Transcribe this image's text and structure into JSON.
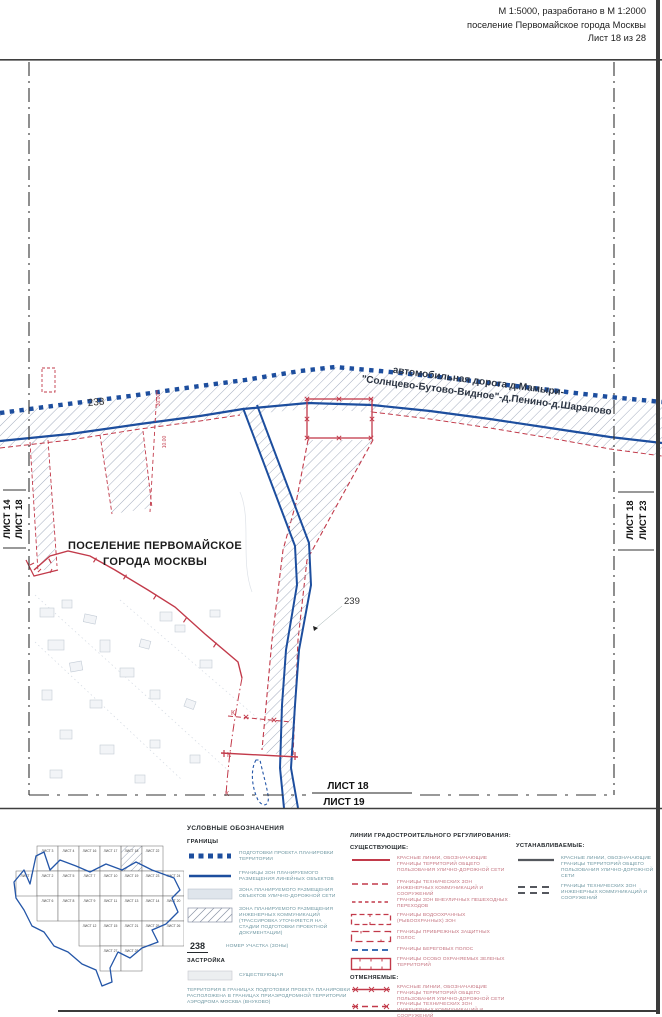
{
  "header": {
    "line1": "М 1:5000, разработано в М 1:2000",
    "line2": "поселение Первомайское города Москвы",
    "line3": "Лист 18 из 28"
  },
  "map": {
    "road_label_1": "автомобильная дорога д.Мамыри-",
    "road_label_2": "\"Солнцево-Бутово-Видное\"-д.Пенино-д.Шарапово",
    "settlement_1": "ПОСЕЛЕНИЕ ПЕРВОМАЙСКОЕ",
    "settlement_2": "ГОРОДА МОСКВЫ",
    "parcel_238": "238",
    "parcel_239": "239",
    "dim_a": "30.00",
    "dim_b": "10.00",
    "k": "К",
    "edge": {
      "left_outer": "ЛИСТ 14",
      "left_inner": "ЛИСТ 18",
      "right_inner": "ЛИСТ 18",
      "right_outer": "ЛИСТ 23",
      "bottom_top": "ЛИСТ 18",
      "bottom_bottom": "ЛИСТ 19"
    }
  },
  "legend": {
    "title": "УСЛОВНЫЕ ОБОЗНАЧЕНИЯ",
    "borders_section": "ГРАНИЦЫ",
    "borders_items": [
      {
        "label": "ПОДГОТОВКИ ПРОЕКТА ПЛАНИРОВКИ ТЕРРИТОРИИ"
      },
      {
        "label": "ГРАНИЦЫ ЗОН ПЛАНИРУЕМОГО РАЗМЕЩЕНИЯ ЛИНЕЙНЫХ ОБЪЕКТОВ"
      },
      {
        "label": "ЗОНА ПЛАНИРУЕМОГО РАЗМЕЩЕНИЯ ОБЪЕКТОВ УЛИЧНО-ДОРОЖНОЙ СЕТИ"
      },
      {
        "label": "ЗОНА ПЛАНИРУЕМОГО РАЗМЕЩЕНИЯ ИНЖЕНЕРНЫХ КОММУНИКАЦИЙ (ТРАССИРОВКА УТОЧНЯЕТСЯ НА СТАДИИ ПОДГОТОВКИ ПРОЕКТНОЙ ДОКУМЕНТАЦИИ)"
      },
      {
        "symbol": "238",
        "label": "НОМЕР УЧАСТКА (ЗОНЫ)"
      }
    ],
    "development_section": "ЗАСТРОЙКА",
    "development_existing": "СУЩЕСТВУЮЩАЯ",
    "note": "ТЕРРИТОРИЯ В ГРАНИЦАХ ПОДГОТОВКИ ПРОЕКТА ПЛАНИРОВКИ РАСПОЛОЖЕНА В ГРАНИЦАХ ПРИАЭРОДРОМНОЙ ТЕРРИТОРИИ АЭРОДРОМА МОСКВА (ВНУКОВО)",
    "lines_title": "ЛИНИИ ГРАДОСТРОИТЕЛЬНОГО РЕГУЛИРОВАНИЯ:",
    "existing_section": "СУЩЕСТВУЮЩИЕ:",
    "existing_items": [
      {
        "label": "КРАСНЫЕ ЛИНИИ, ОБОЗНАЧАЮЩИЕ ГРАНИЦЫ ТЕРРИТОРИЙ ОБЩЕГО ПОЛЬЗОВАНИЯ УЛИЧНО-ДОРОЖНОЙ СЕТИ"
      },
      {
        "label": "ГРАНИЦЫ ТЕХНИЧЕСКИХ ЗОН ИНЖЕНЕРНЫХ КОММУНИКАЦИЙ И СООРУЖЕНИЙ"
      },
      {
        "label": "ГРАНИЦЫ ЗОН ВНЕУЛИЧНЫХ ПЕШЕХОДНЫХ ПЕРЕХОДОВ"
      },
      {
        "label": "ГРАНИЦЫ ВОДООХРАННЫХ (РЫБООХРАННЫХ) ЗОН"
      },
      {
        "label": "ГРАНИЦЫ ПРИБРЕЖНЫХ ЗАЩИТНЫХ ПОЛОС"
      },
      {
        "label": "ГРАНИЦЫ БЕРЕГОВЫХ ПОЛОС"
      },
      {
        "label": "ГРАНИЦЫ ОСОБО ОХРАНЯЕМЫХ ЗЕЛЕНЫХ ТЕРРИТОРИЙ"
      }
    ],
    "cancelled_section": "ОТМЕНЯЕМЫЕ:",
    "cancelled_items": [
      {
        "label": "КРАСНЫЕ ЛИНИИ, ОБОЗНАЧАЮЩИЕ ГРАНИЦЫ ТЕРРИТОРИЙ ОБЩЕГО ПОЛЬЗОВАНИЯ УЛИЧНО-ДОРОЖНОЙ СЕТИ"
      },
      {
        "label": "ГРАНИЦЫ ТЕХНИЧЕСКИХ ЗОН ИНЖЕНЕРНЫХ КОММУНИКАЦИЙ И СООРУЖЕНИЙ"
      }
    ],
    "established_section": "УСТАНАВЛИВАЕМЫЕ:",
    "established_items": [
      {
        "label": "КРАСНЫЕ ЛИНИИ, ОБОЗНАЧАЮЩИЕ ГРАНИЦЫ ТЕРРИТОРИЙ ОБЩЕГО ПОЛЬЗОВАНИЯ УЛИЧНО-ДОРОЖНОЙ СЕТИ"
      },
      {
        "label": "ГРАНИЦЫ ТЕХНИЧЕСКИХ ЗОН ИНЖЕНЕРНЫХ КОММУНИКАЦИЙ И СООРУЖЕНИЙ"
      }
    ]
  },
  "minimap": {
    "sheet_prefix": "ЛИСТ",
    "current": "18",
    "cells": [
      {
        "n": "3",
        "c": 1,
        "r": 0
      },
      {
        "n": "4",
        "c": 2,
        "r": 0
      },
      {
        "n": "16",
        "c": 3,
        "r": 0
      },
      {
        "n": "17",
        "c": 4,
        "r": 0
      },
      {
        "n": "18",
        "c": 5,
        "r": 0
      },
      {
        "n": "22",
        "c": 6,
        "r": 0
      },
      {
        "n": "1",
        "c": 0,
        "r": 1
      },
      {
        "n": "2",
        "c": 1,
        "r": 1
      },
      {
        "n": "5",
        "c": 2,
        "r": 1
      },
      {
        "n": "7",
        "c": 3,
        "r": 1
      },
      {
        "n": "10",
        "c": 4,
        "r": 1
      },
      {
        "n": "19",
        "c": 5,
        "r": 1
      },
      {
        "n": "23",
        "c": 6,
        "r": 1
      },
      {
        "n": "24",
        "c": 7,
        "r": 1
      },
      {
        "n": "6",
        "c": 1,
        "r": 2
      },
      {
        "n": "8",
        "c": 2,
        "r": 2
      },
      {
        "n": "9",
        "c": 3,
        "r": 2
      },
      {
        "n": "11",
        "c": 4,
        "r": 2
      },
      {
        "n": "13",
        "c": 5,
        "r": 2
      },
      {
        "n": "14",
        "c": 6,
        "r": 2
      },
      {
        "n": "20",
        "c": 7,
        "r": 2
      },
      {
        "n": "12",
        "c": 3,
        "r": 3
      },
      {
        "n": "15",
        "c": 4,
        "r": 3
      },
      {
        "n": "21",
        "c": 5,
        "r": 3
      },
      {
        "n": "25",
        "c": 6,
        "r": 3
      },
      {
        "n": "26",
        "c": 7,
        "r": 3
      },
      {
        "n": "27",
        "c": 4,
        "r": 4
      },
      {
        "n": "28",
        "c": 5,
        "r": 4
      }
    ]
  }
}
